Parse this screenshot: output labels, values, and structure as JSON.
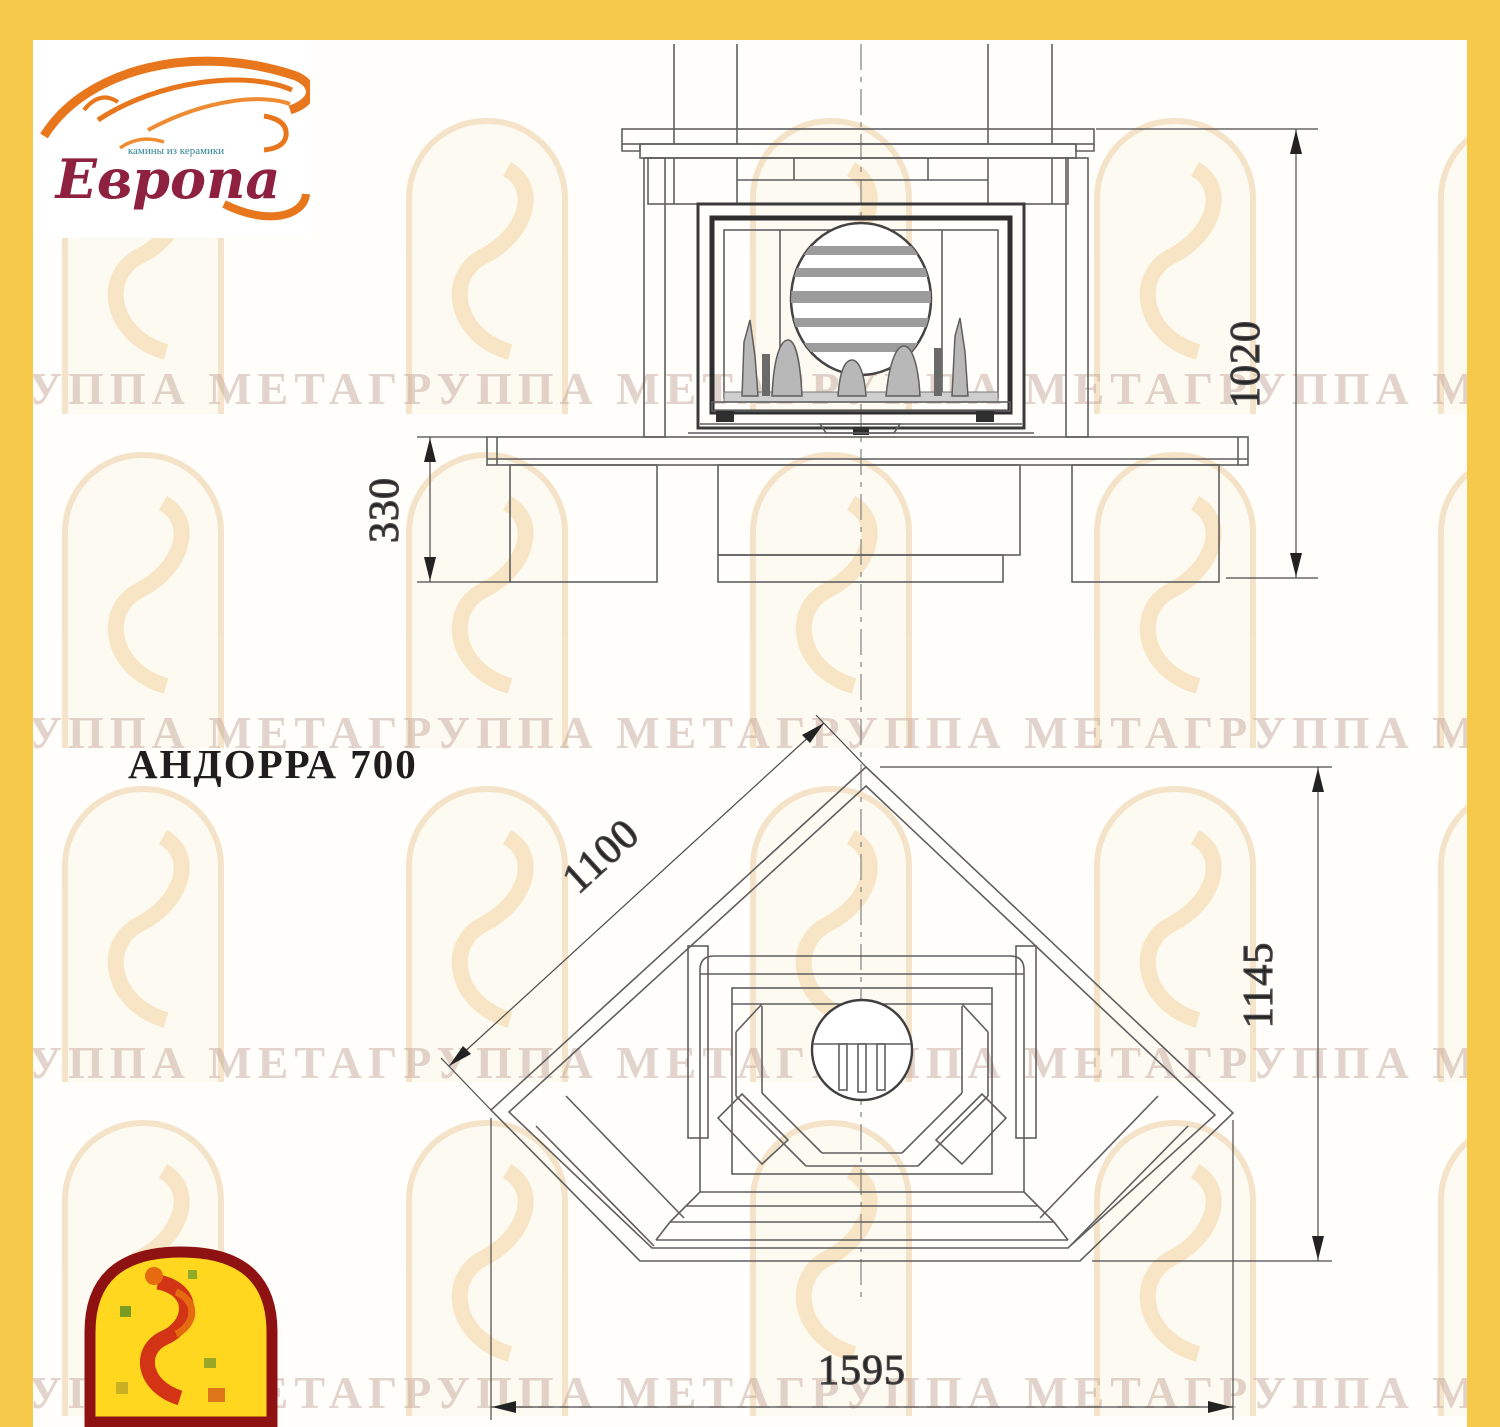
{
  "sheet": {
    "background": "#fffefa",
    "border_color": "#f6c94b",
    "line_color": "#5f5f5f"
  },
  "header_logo": {
    "brand": "Европа",
    "tagline": "камины из керамики",
    "flame_color": "#e8761c",
    "brand_color": "#8e2140",
    "tagline_color": "#2e8391"
  },
  "title_block": {
    "model_label": "АНДОРРА 700"
  },
  "front_view": {
    "view_name": "front-elevation",
    "dim_total_height": "1020",
    "dim_hearth_height": "330"
  },
  "plan_view": {
    "view_name": "top-plan",
    "dim_side": "1100",
    "dim_depth": "1145",
    "dim_width": "1595"
  },
  "watermark": {
    "text": "ГРУППА МЕТАГРУППА МЕТАГРУППА МЕТАГРУППА МЕТА",
    "rows_y": [
      362,
      706,
      1036,
      1366
    ],
    "arch_rows_y": [
      118,
      452,
      786,
      1120
    ],
    "arch_cols_x": [
      62,
      406,
      750,
      1094,
      1438
    ]
  }
}
